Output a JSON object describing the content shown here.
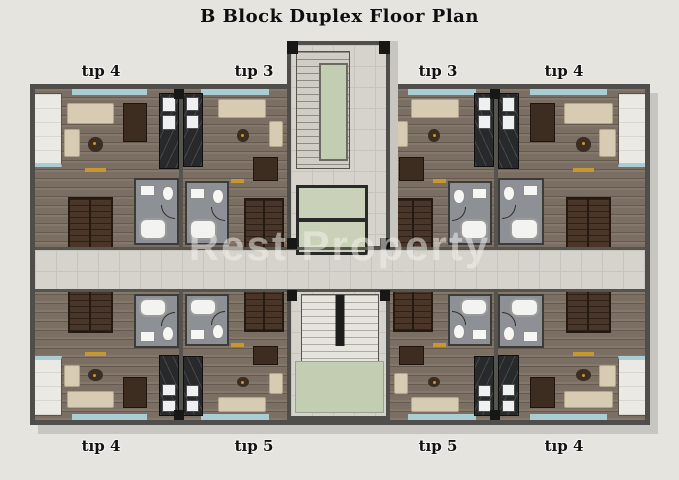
{
  "title": "B Block Duplex Floor Plan",
  "watermark": {
    "brand": "Rest Property",
    "subtitle": "недвижимость"
  },
  "unit_labels": {
    "top": [
      "tıp 4",
      "tıp 3",
      "tıp 3",
      "tıp 4"
    ],
    "bottom": [
      "tıp 4",
      "tıp 5",
      "tıp 5",
      "tıp 4"
    ]
  },
  "core": {
    "features": [
      "stairwell",
      "elevator",
      "shafts",
      "entry-stair",
      "entrance-pad"
    ]
  },
  "colors": {
    "background": "#e6e4df",
    "wall": "#4f4e4a",
    "column": "#171715",
    "wood_floor": "#7b6e62",
    "corridor_tile": "#d6d3cc",
    "balcony_tile": "#ebe9e4",
    "elevator_green": "#c3cdb2",
    "balcony_teal": "#a9cdd3",
    "kitchen_marble": "#27292b",
    "duplex_stair_brown": "#4a3629",
    "sofa_cream": "#d8cbb4",
    "dining_brown": "#3c2d20",
    "bathroom_gray": "#8d9094",
    "fixture_white": "#f3f3f1",
    "accent_gold": "#c9972f",
    "watermark_text": "rgba(243,241,236,0.52)"
  }
}
